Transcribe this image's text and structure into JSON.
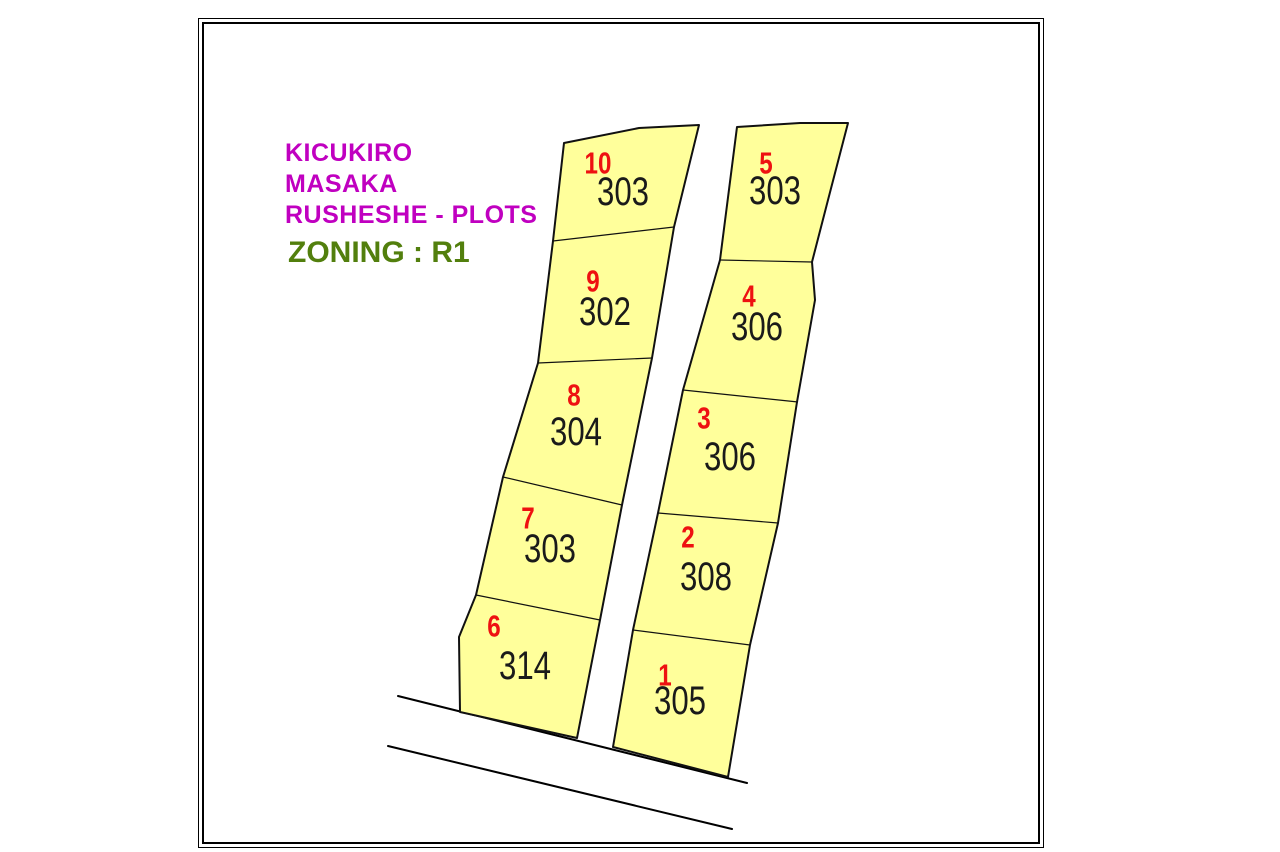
{
  "map_title": {
    "lines": [
      "KICUKIRO",
      "MASAKA",
      "RUSHESHE - PLOTS"
    ],
    "zoning_label": "ZONING : R1"
  },
  "plots": [
    {
      "number": "1",
      "area": "305"
    },
    {
      "number": "2",
      "area": "308"
    },
    {
      "number": "3",
      "area": "306"
    },
    {
      "number": "4",
      "area": "306"
    },
    {
      "number": "5",
      "area": "303"
    },
    {
      "number": "6",
      "area": "314"
    },
    {
      "number": "7",
      "area": "303"
    },
    {
      "number": "8",
      "area": "304"
    },
    {
      "number": "9",
      "area": "302"
    },
    {
      "number": "10",
      "area": "303"
    }
  ],
  "colors": {
    "plot-fill": "#FFFF9B",
    "plot-outline": "#111111",
    "plot-number": "#EE1111",
    "plot-area-text": "#1A1A1A",
    "title-magenta": "#C000C0",
    "zoning-green": "#527F0D",
    "frame-border": "#000000",
    "road-line": "#000000"
  }
}
